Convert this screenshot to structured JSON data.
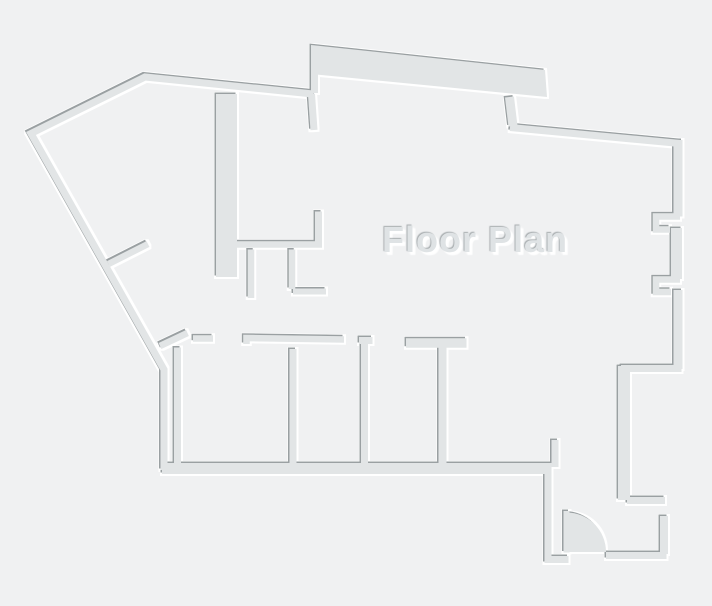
{
  "title": "Floor Plan",
  "palette": {
    "background": "#f0f1f2",
    "wall_fill": "#e2e5e6",
    "edge_shadow": "#9aa0a2",
    "edge_highlight": "#ffffff",
    "title_color": "#dfe3e5"
  },
  "features": {
    "door": "quarter-circle swing door, bottom-right entry",
    "style": "embossed walls: dark edge top-left, white highlight bottom-right"
  }
}
